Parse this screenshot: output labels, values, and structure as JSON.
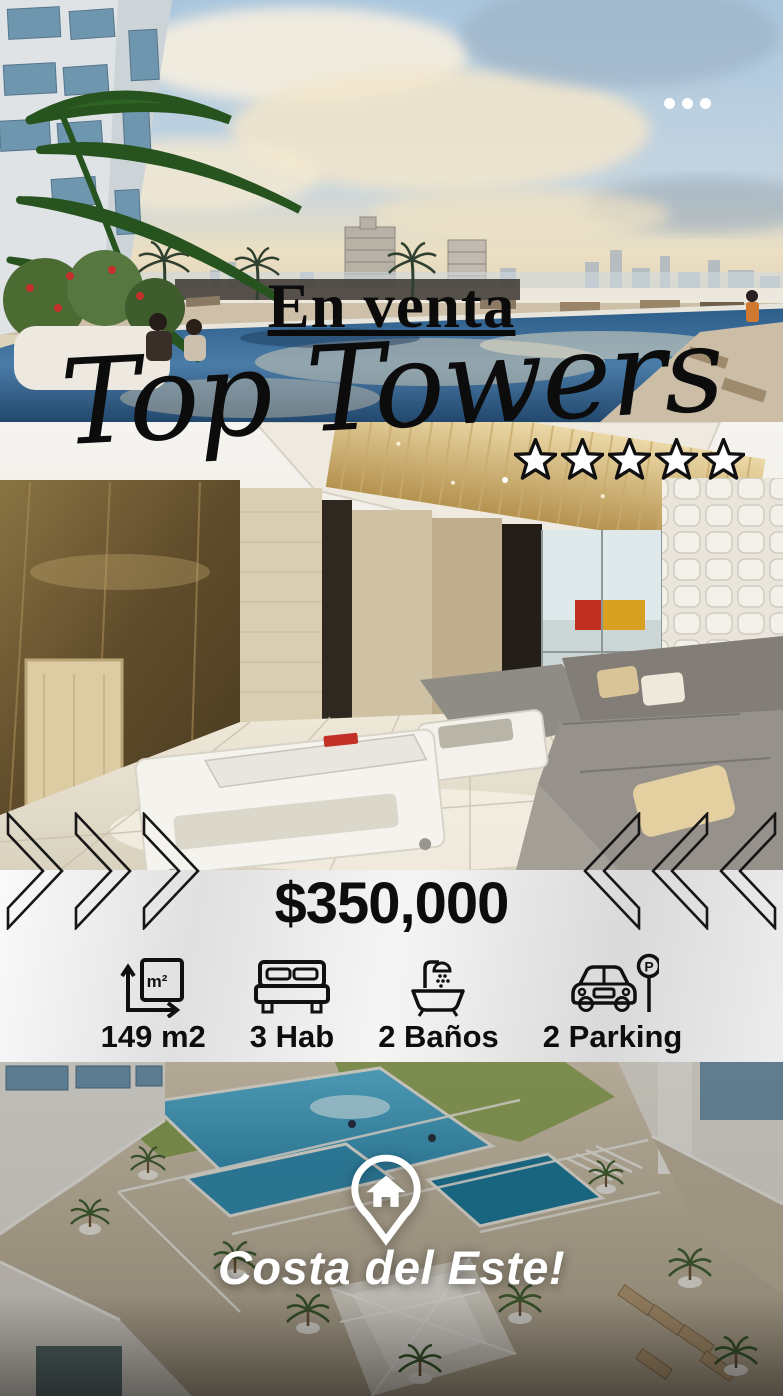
{
  "header": {
    "sale_label": "En venta",
    "title": "Top Towers",
    "rating": 5
  },
  "menu": {
    "icon": "ellipsis"
  },
  "pricing": {
    "price": "$350,000"
  },
  "features": [
    {
      "icon": "area-icon",
      "icon_text": "m²",
      "label": "149 m2"
    },
    {
      "icon": "bed-icon",
      "label": "3 Hab"
    },
    {
      "icon": "bath-icon",
      "label": "2 Baños"
    },
    {
      "icon": "parking-icon",
      "sign_text": "P",
      "label": "2 Parking"
    }
  ],
  "location": {
    "icon": "home-location-pin",
    "label": "Costa del Este!"
  },
  "colors": {
    "text_dark": "#0d0d0d",
    "text_light": "#ffffff",
    "star_fill": "#ffffff",
    "star_outline": "#101010",
    "band_background": "#e9e9e9"
  },
  "photos": {
    "top": "rooftop-pool-sunset",
    "middle": "lobby-interior",
    "bottom": "aerial-pool-deck"
  }
}
